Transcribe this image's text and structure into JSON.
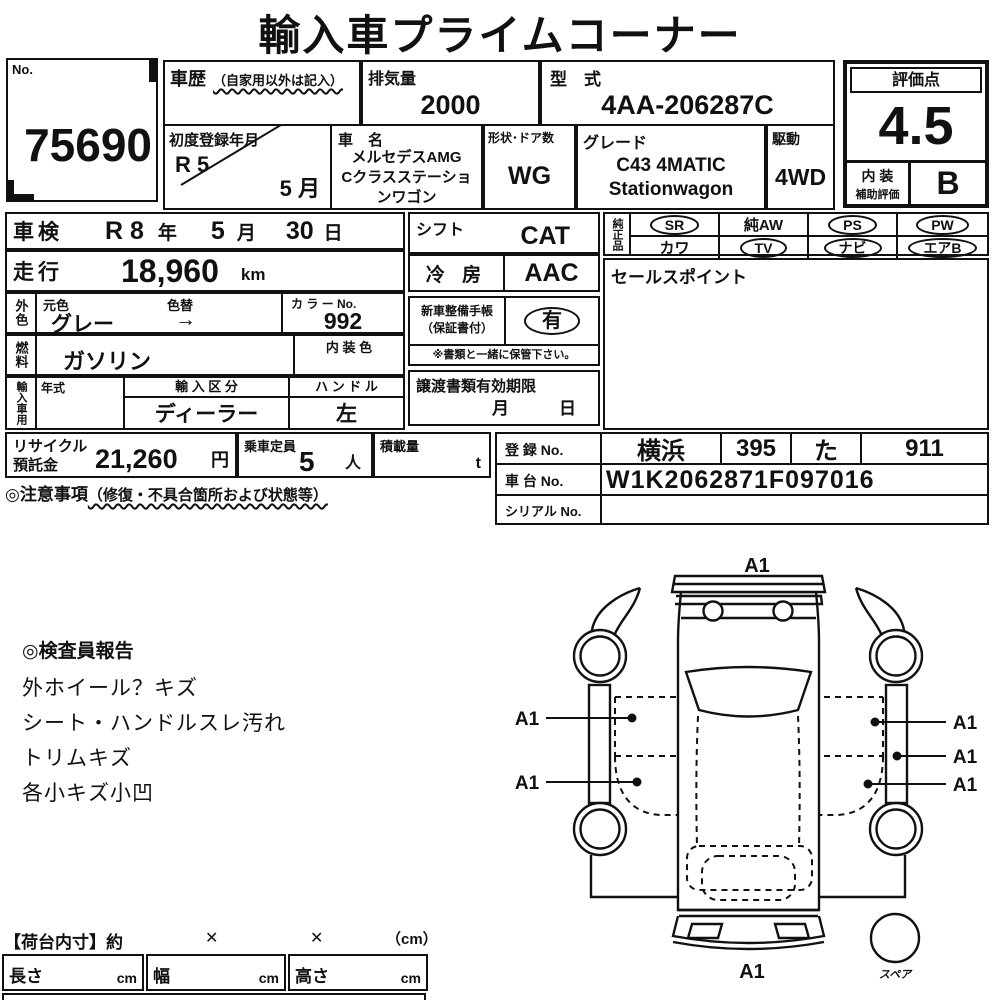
{
  "title": "輸入車プライムコーナー",
  "header": {
    "no_label": "No.",
    "no_value": "75690",
    "history_label": "車歴",
    "history_note": "（自家用以外は記入）",
    "displacement_label": "排気量",
    "displacement_value": "2000",
    "model_code_label": "型　式",
    "model_code_value": "4AA-206287C",
    "first_reg_label": "初度登録年月",
    "first_reg_year": "R 5",
    "first_reg_month": "5 月",
    "car_name_label": "車　名",
    "car_name_line1": "メルセデスAMG",
    "car_name_line2": "Cクラスステーショ",
    "car_name_line3": "ンワゴン",
    "body_doors_label": "形状･ドア数",
    "body_doors_value": "WG",
    "grade_label": "グレード",
    "grade_line1": "C43  4MATIC",
    "grade_line2": "Stationwagon",
    "drive_label": "駆動",
    "drive_value": "4WD",
    "score_label": "評価点",
    "score_value": "4.5",
    "interior_label1": "内 装",
    "interior_label2": "補助評価",
    "interior_value": "B"
  },
  "left": {
    "shaken": {
      "label": "車検",
      "v1": "R 8",
      "u1": "年",
      "v2": "5",
      "u2": "月",
      "v3": "30",
      "u3": "日"
    },
    "mileage": {
      "label": "走行",
      "value": "18,960",
      "unit": "km"
    },
    "color": {
      "group_label": "外色",
      "orig_label": "元色",
      "change_label": "色替",
      "value": "グレー",
      "arrow": "→",
      "no_label": "カ ラ ー No.",
      "no_value": "992"
    },
    "fuel": {
      "group_label": "燃料",
      "value": "ガソリン",
      "interior_color_label": "内 装 色"
    },
    "import": {
      "group_label": "輸入車用",
      "year_label": "年式",
      "division_label": "輸 入 区 分",
      "division_value": "ディーラー",
      "handle_label": "ハ ン ド ル",
      "handle_value": "左"
    }
  },
  "middle": {
    "shift": {
      "label": "シフト",
      "value": "CAT"
    },
    "ac": {
      "label": "冷 房",
      "value": "AAC"
    },
    "service_book": {
      "label1": "新車整備手帳",
      "label2": "（保証書付）",
      "value": "有",
      "note": "※書類と一緒に保管下さい。"
    },
    "transfer": {
      "label": "譲渡書類有効期限",
      "month_unit": "月",
      "day_unit": "日"
    }
  },
  "right": {
    "oem_label": "純正品",
    "oem_items": [
      {
        "label": "SR",
        "circled": true
      },
      {
        "label": "純AW",
        "circled": false
      },
      {
        "label": "PS",
        "circled": true
      },
      {
        "label": "PW",
        "circled": true
      },
      {
        "label": "カワ",
        "circled": false
      },
      {
        "label": "TV",
        "circled": true
      },
      {
        "label": "ナビ",
        "circled": true
      },
      {
        "label": "エアB",
        "circled": true
      }
    ],
    "sales_point_label": "セールスポイント"
  },
  "bottom": {
    "recycle_label1": "リサイクル",
    "recycle_label2": "預託金",
    "recycle_value": "21,260",
    "recycle_unit": "円",
    "capacity_label": "乗車定員",
    "capacity_value": "5",
    "capacity_unit": "人",
    "load_label": "積載量",
    "load_unit": "t",
    "reg_no_label": "登 録 No.",
    "reg_area": "横浜",
    "reg_class": "395",
    "reg_kana": "た",
    "reg_number": "911",
    "chassis_label": "車 台 No.",
    "chassis_value": "W1K2062871F097016",
    "serial_label": "シリアル No."
  },
  "notes": {
    "caution_title": "◎注意事項",
    "caution_sub": "（修復・不具合箇所および状態等）",
    "inspector_title": "◎検査員報告",
    "inspector_lines": [
      "外ホイール？キズ",
      "シート・ハンドルスレ汚れ",
      "トリムキズ",
      "各小キズ小凹"
    ]
  },
  "cargo": {
    "title": "【荷台内寸】約",
    "x1": "✕",
    "x2": "✕",
    "unit": "（cm）",
    "length_label": "長さ",
    "width_label": "幅",
    "height_label": "高さ",
    "cm": "cm"
  },
  "diagram": {
    "marks": [
      "A1",
      "A1",
      "A1",
      "A1",
      "A1",
      "A1",
      "A1"
    ],
    "spare_label": "スペア"
  }
}
